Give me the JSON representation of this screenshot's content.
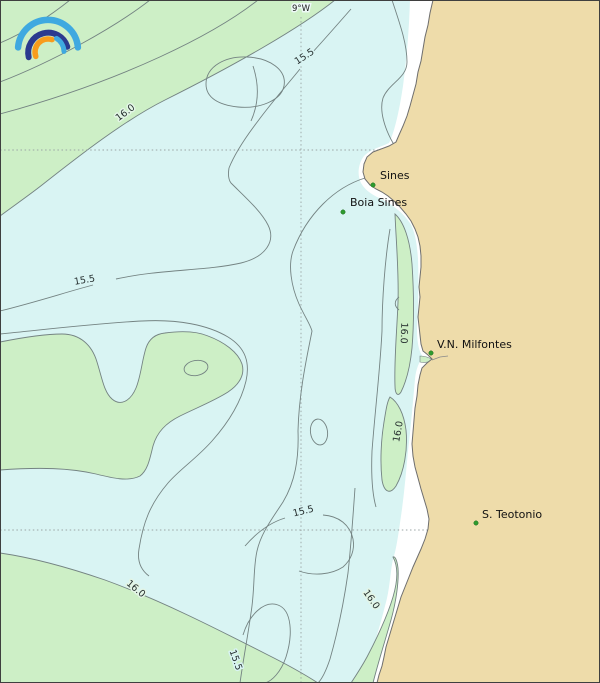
{
  "map": {
    "meridian_label": "9°W",
    "isotherm_levels": [
      "15.5",
      "16.0"
    ],
    "contour_labels": [
      "16.0",
      "15.5",
      "15.5",
      "16.0",
      "16.0",
      "15.5",
      "16.0",
      "16.0",
      "15.5"
    ],
    "places": [
      {
        "name": "Sines"
      },
      {
        "name": "Boia Sines"
      },
      {
        "name": "V.N. Milfontes"
      },
      {
        "name": "S. Teotonio"
      }
    ],
    "colors": {
      "ocean": "#d9f4f3",
      "warm_water": "#cdefc6",
      "land": "#eedcaa",
      "nearshore_gap": "#ffffff",
      "contour_line": "#748382",
      "coastline": "#6e6e6e",
      "gridline": "#9aa4a4",
      "place_marker": "#2e9b2e",
      "label_text": "#111111",
      "logo_light_blue": "#3fa9e0",
      "logo_dark_blue": "#2b3a8f",
      "logo_orange": "#f89c1c"
    },
    "logo": {
      "name": "ipma-rainbow-logo"
    }
  },
  "chart_data": {
    "type": "contour",
    "levels": [
      15.5,
      16.0
    ],
    "meridian": "9°W",
    "labeled_points": [
      "Sines",
      "Boia Sines",
      "V.N. Milfontes",
      "S. Teotonio"
    ]
  }
}
